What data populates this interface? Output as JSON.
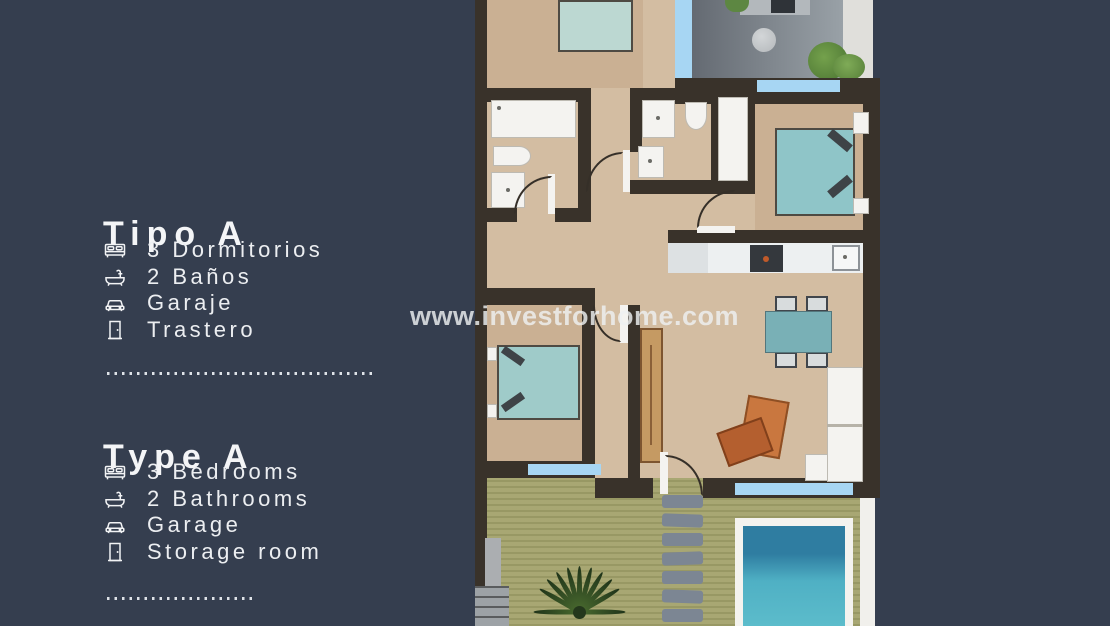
{
  "watermark": {
    "text": "www.investforhome.com",
    "color": "#eef0f2"
  },
  "sections": {
    "es": {
      "title": "Tipo A",
      "items": [
        {
          "icon": "bed-icon",
          "label": "3 Dormitorios"
        },
        {
          "icon": "bathtub-icon",
          "label": "2 Baños"
        },
        {
          "icon": "car-icon",
          "label": "Garaje"
        },
        {
          "icon": "door-icon",
          "label": "Trastero"
        }
      ]
    },
    "en": {
      "title": "Type A",
      "items": [
        {
          "icon": "bed-icon",
          "label": "3 Bedrooms"
        },
        {
          "icon": "bathtub-icon",
          "label": "2 Bathrooms"
        },
        {
          "icon": "car-icon",
          "label": "Garage"
        },
        {
          "icon": "door-icon",
          "label": "Storage room"
        }
      ]
    }
  },
  "floorplan": {
    "type": "apartment-top-view-render",
    "rooms": [
      "bedroom-top",
      "terrace",
      "bathroom-1",
      "bathroom-2",
      "closet",
      "bedroom-right",
      "kitchen",
      "dining-living",
      "bedroom-bottom",
      "garden",
      "pool"
    ],
    "colors": {
      "background": "#353e4f",
      "wall": "#39322a",
      "floor": "#d3bda2",
      "terrace": "#8f969c",
      "window_blue": "#a7d6f3",
      "bed_teal": "#9fcbc9",
      "dining_table": "#79b0b6",
      "armchair_orange": "#c9773f",
      "garden_green": "#a3a26c",
      "pool_water": "#4fb0c4",
      "fixture_white": "#f4f3f0"
    }
  }
}
